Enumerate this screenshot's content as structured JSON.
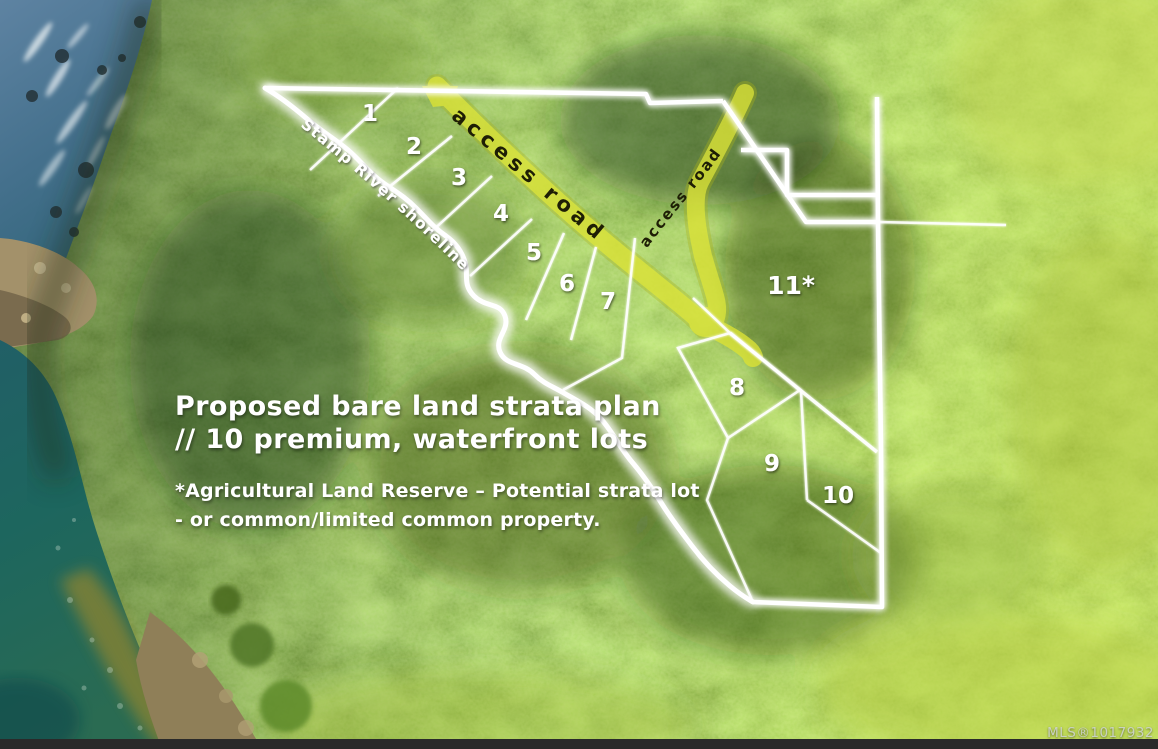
{
  "overlay": {
    "title_line1": "Proposed bare land strata plan",
    "title_line2": "// 10 premium, waterfront lots",
    "note_line1": "*Agricultural Land Reserve – Potential strata lot",
    "note_line2": "- or common/limited common property.",
    "shoreline_label": "Stamp River shoreline",
    "road_labels": [
      "access road",
      "access road"
    ],
    "mls": "MLS®1017932"
  },
  "lots": [
    {
      "label": "1"
    },
    {
      "label": "2"
    },
    {
      "label": "3"
    },
    {
      "label": "4"
    },
    {
      "label": "5"
    },
    {
      "label": "6"
    },
    {
      "label": "7"
    },
    {
      "label": "8"
    },
    {
      "label": "9"
    },
    {
      "label": "10"
    },
    {
      "label": "11*"
    }
  ],
  "colors": {
    "boundary_line": "#ffffff",
    "access_road": "#d9e136",
    "road_text": "#1e1e05",
    "overlay_text": "#ffffff",
    "mls_text": "#ccd2d4"
  }
}
